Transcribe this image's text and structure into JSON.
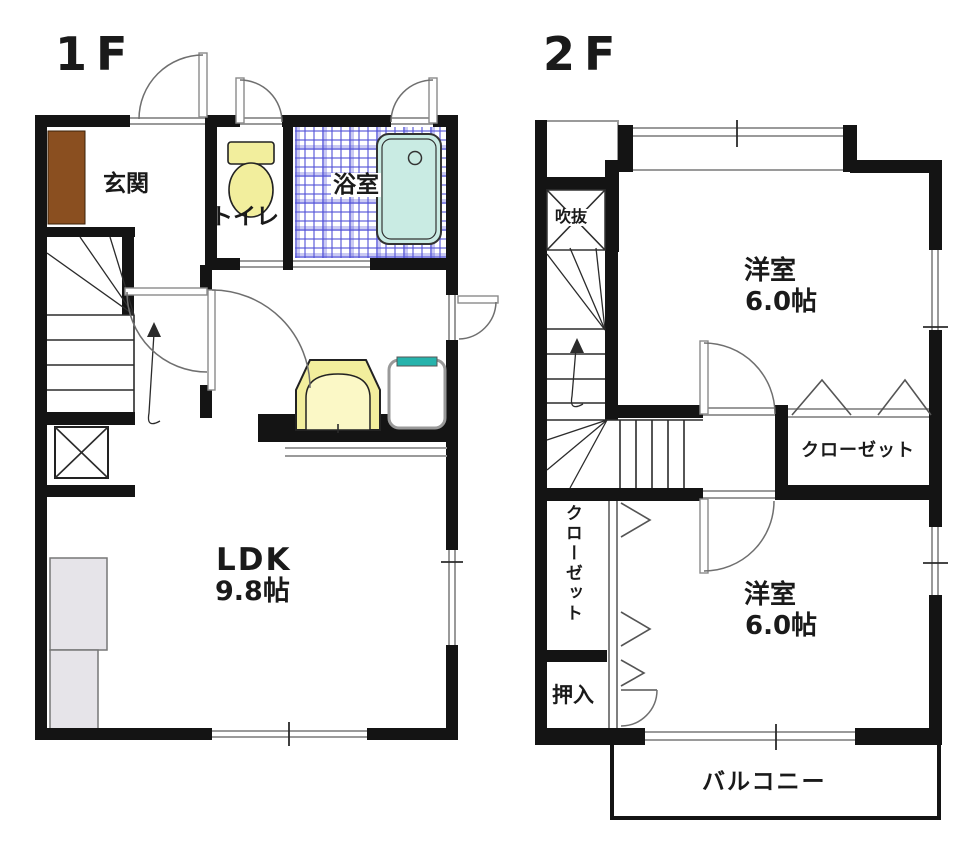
{
  "floor1": {
    "label": "1F",
    "genkan": "玄関",
    "toilet": "トイレ",
    "bath": "浴室",
    "ldk": "LDK",
    "ldk_size": "9.8帖"
  },
  "floor2": {
    "label": "2F",
    "void": "吹抜",
    "bedroom1": "洋室",
    "bedroom1_size": "6.0帖",
    "closet_top": "クローゼット",
    "closet_side": "クローゼット",
    "oshiire": "押入",
    "bedroom2": "洋室",
    "bedroom2_size": "6.0帖",
    "balcony": "バルコニー"
  },
  "colors": {
    "wall": "#141414",
    "genkan_step": "#8a4f20",
    "sanitary_yellow": "#f2ee9d",
    "bathtub": "#c9ebe3",
    "bath_tile_blue": "#5050d7",
    "washer_accent": "#27b3ac",
    "counter_gray": "#e6e4e9"
  }
}
